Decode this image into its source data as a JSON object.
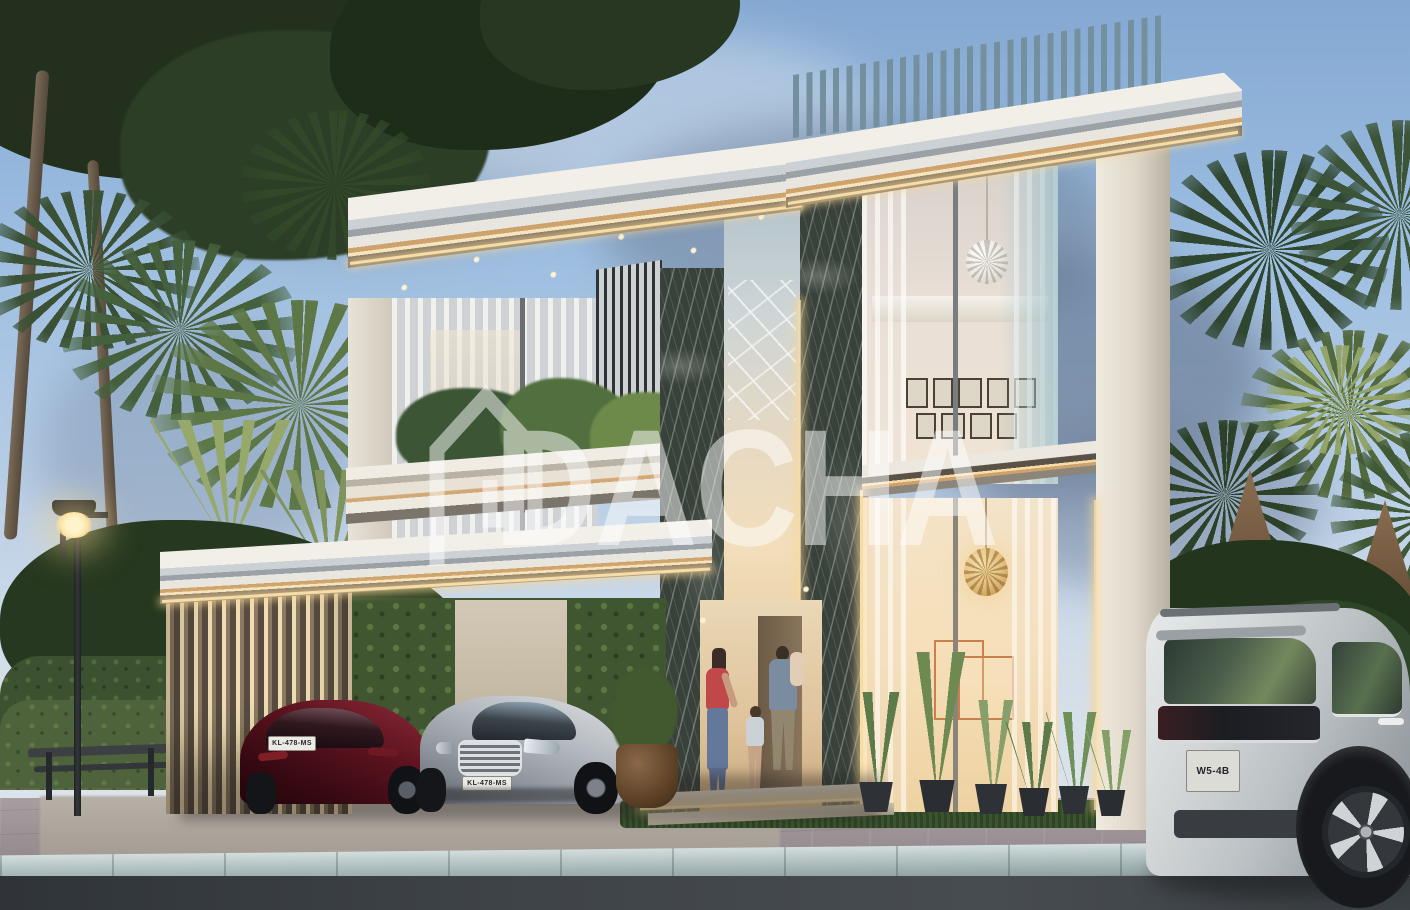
{
  "meta": {
    "description": "Dusk 3D architectural rendering of a modern two-storey luxury villa: rooftop louvre screen, stepped white roof slabs with warm LED strips, dark marble piers, double-height glazing, carport with louvre wall sheltering two cars, family at the entrance, palm garden, street lamp, bench, and a white SUV in the right foreground",
    "canvas": {
      "width": 1410,
      "height": 910
    }
  },
  "watermark": {
    "brand": "DACHA",
    "icon": "house-outline-icon",
    "color": "#ffffff",
    "opacity": 0.5
  },
  "vehicles": {
    "red_hatchback": {
      "color_name": "dark red",
      "plate": "KL-478-MS"
    },
    "silver_sedan": {
      "color_name": "silver",
      "plate": "KL-478-MS"
    },
    "white_suv": {
      "color_name": "pearl white",
      "plate": "W5-4B"
    }
  },
  "palette": {
    "sky_top": "#84a8d2",
    "sky_horizon": "#e2e7ec",
    "cloud": "#6f8097",
    "foliage_dark": "#24331f",
    "foliage_light": "#7d9a5d",
    "wall_white": "#ece8df",
    "marble_dark": "#39413b",
    "led_warm": "#f6dca6",
    "copper_accent": "#cda26c",
    "interior_warm": "#f3dfbd",
    "glass_cool": "#b9cede",
    "road_asphalt": "#3e4347"
  }
}
